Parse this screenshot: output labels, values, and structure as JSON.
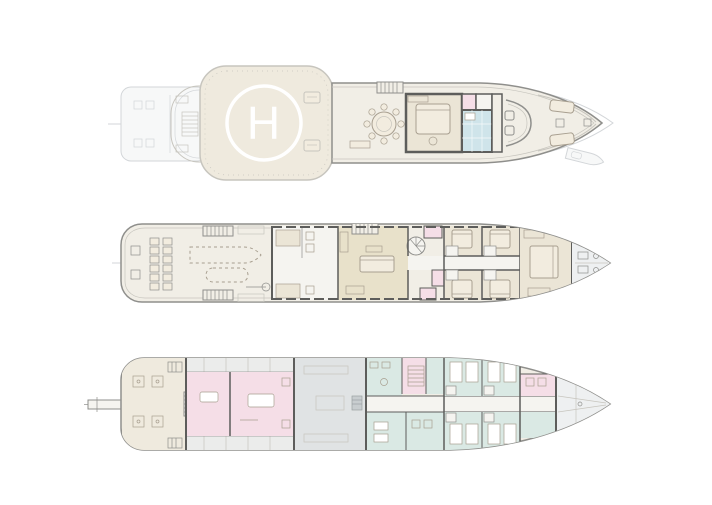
{
  "page": {
    "kind": "yacht-general-arrangement",
    "background": "#ffffff"
  },
  "helipad": {
    "marking": "H"
  },
  "palette": {
    "background": "#ffffff",
    "hull_line": "#8f8f8c",
    "wall": "#5d5d5b",
    "light_line": "#c7c5be",
    "ghost_line": "#d3d6d9",
    "ghost_fill": "#f7f8f8",
    "furniture_line": "#a89f90",
    "furniture_fill": "#f2ecdf",
    "deck_base": "#f1eee6",
    "helipad_cream": "#efeade",
    "room_beige": "#ebe5d6",
    "salon_tan": "#e8e1ca",
    "room_pink": "#f5dee7",
    "room_blue": "#cfe4ea",
    "room_teal": "#dae9e4",
    "engine_gray": "#e0e3e4",
    "foredeck_gray": "#eef0f1",
    "corridor_white": "#f5f4f0",
    "helipad_mark": "#ffffff"
  },
  "decks": [
    {
      "id": "sun-deck",
      "areas": [
        {
          "name": "aft-swim-platform-ghost",
          "color_key": "ghost_fill"
        },
        {
          "name": "helipad",
          "color_key": "helipad_cream"
        },
        {
          "name": "sky-lounge",
          "color_key": "room_beige"
        },
        {
          "name": "bathroom",
          "color_key": "room_blue"
        },
        {
          "name": "bridge",
          "color_key": "deck_base"
        },
        {
          "name": "bow-seating",
          "color_key": "deck_base"
        }
      ]
    },
    {
      "id": "main-deck",
      "areas": [
        {
          "name": "stern-seating",
          "color_key": "deck_base"
        },
        {
          "name": "tender-deck",
          "color_key": "deck_base"
        },
        {
          "name": "galley",
          "color_key": "corridor_white"
        },
        {
          "name": "salon",
          "color_key": "salon_tan"
        },
        {
          "name": "guest-cabins",
          "color_key": "room_beige"
        },
        {
          "name": "wet-rooms",
          "color_key": "room_pink"
        },
        {
          "name": "master-cabin",
          "color_key": "room_beige"
        },
        {
          "name": "foredeck",
          "color_key": "foredeck_gray"
        }
      ]
    },
    {
      "id": "lower-deck",
      "areas": [
        {
          "name": "gangway",
          "color_key": "corridor_white"
        },
        {
          "name": "beach-club",
          "color_key": "helipad_cream"
        },
        {
          "name": "spa-rooms",
          "color_key": "room_pink"
        },
        {
          "name": "engine-room",
          "color_key": "engine_gray"
        },
        {
          "name": "galley-crew-mess",
          "color_key": "room_teal"
        },
        {
          "name": "crew-cabins",
          "color_key": "room_teal"
        },
        {
          "name": "laundry",
          "color_key": "room_pink"
        },
        {
          "name": "bow-locker",
          "color_key": "foredeck_gray"
        }
      ]
    }
  ]
}
